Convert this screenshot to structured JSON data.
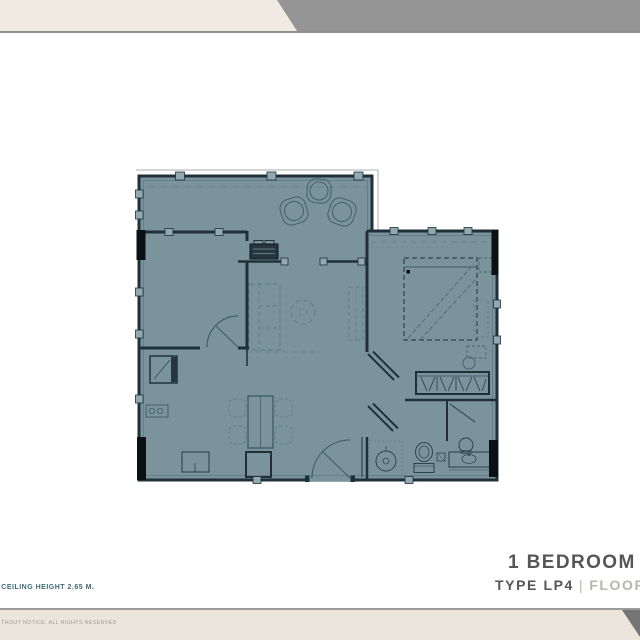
{
  "header": {
    "bar_color": "#f0ebe2",
    "wedge_color": "#959595",
    "rule_color": "#8f8f8f"
  },
  "plan": {
    "fill_color": "#7b949c",
    "wall_color": "#1f3038",
    "column_color": "#0a1014",
    "roofline_color": "#c8c8c8"
  },
  "notes": {
    "ceiling_note": "- CEILING HEIGHT 2.65 M."
  },
  "title_block": {
    "title": "1 BEDROOM",
    "type_label": "TYPE LP4",
    "divider": "|",
    "plan_label": "FLOOR PLAN",
    "title_color": "#565658",
    "muted_color": "#b9b4ae"
  },
  "footer": {
    "bar_color": "#ece5dc",
    "wedge_color": "#757578",
    "rule_color": "#9c9c9a",
    "rights_text": "THOUT NOTICE. ALL RIGHTS RESERVED",
    "text_color": "#a49b93"
  }
}
